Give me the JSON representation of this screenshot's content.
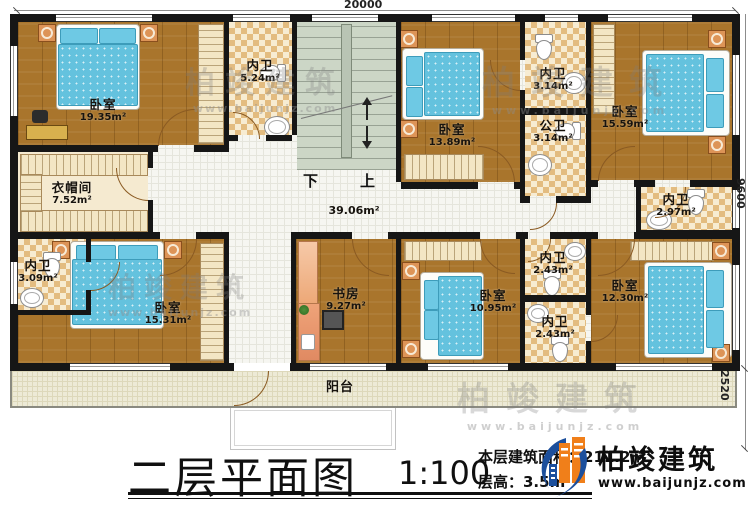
{
  "dims": {
    "top": "20000",
    "right_upper": "9600",
    "right_lower": "2520"
  },
  "hall": {
    "area": "39.06m²"
  },
  "stairs": {
    "down": "下",
    "up": "上"
  },
  "rooms": [
    {
      "name": "卧室",
      "area": "19.35m²"
    },
    {
      "name": "内卫",
      "area": "5.24m²"
    },
    {
      "name": "卧室",
      "area": "13.89m²"
    },
    {
      "name": "内卫",
      "area": "3.14m²"
    },
    {
      "name": "公卫",
      "area": "3.14m²"
    },
    {
      "name": "卧室",
      "area": "15.59m²"
    },
    {
      "name": "内卫",
      "area": "2.97m²"
    },
    {
      "name": "衣帽间",
      "area": "7.52m²"
    },
    {
      "name": "内卫",
      "area": "3.09m²"
    },
    {
      "name": "卧室",
      "area": "15.31m²"
    },
    {
      "name": "书房",
      "area": "9.27m²"
    },
    {
      "name": "卧室",
      "area": "10.95m²"
    },
    {
      "name": "内卫",
      "area": "2.43m²"
    },
    {
      "name": "内卫",
      "area": "2.43m²"
    },
    {
      "name": "卧室",
      "area": "12.30m²"
    },
    {
      "name": "阳台",
      "area": ""
    }
  ],
  "title": {
    "main": "二层平面图",
    "scale": "1:100",
    "area_line": "本层建筑面积：211.2㎡",
    "height_line": "层高：3.5m"
  },
  "brand": {
    "name": "柏竣建筑",
    "url": "www.baijunjz.com"
  },
  "watermark": {
    "name": "柏竣建筑",
    "url": "www.baijunjz.com"
  },
  "colors": {
    "accent_blue": "#1c4f9c",
    "accent_orange": "#f07f1a",
    "wall": "#161616"
  }
}
